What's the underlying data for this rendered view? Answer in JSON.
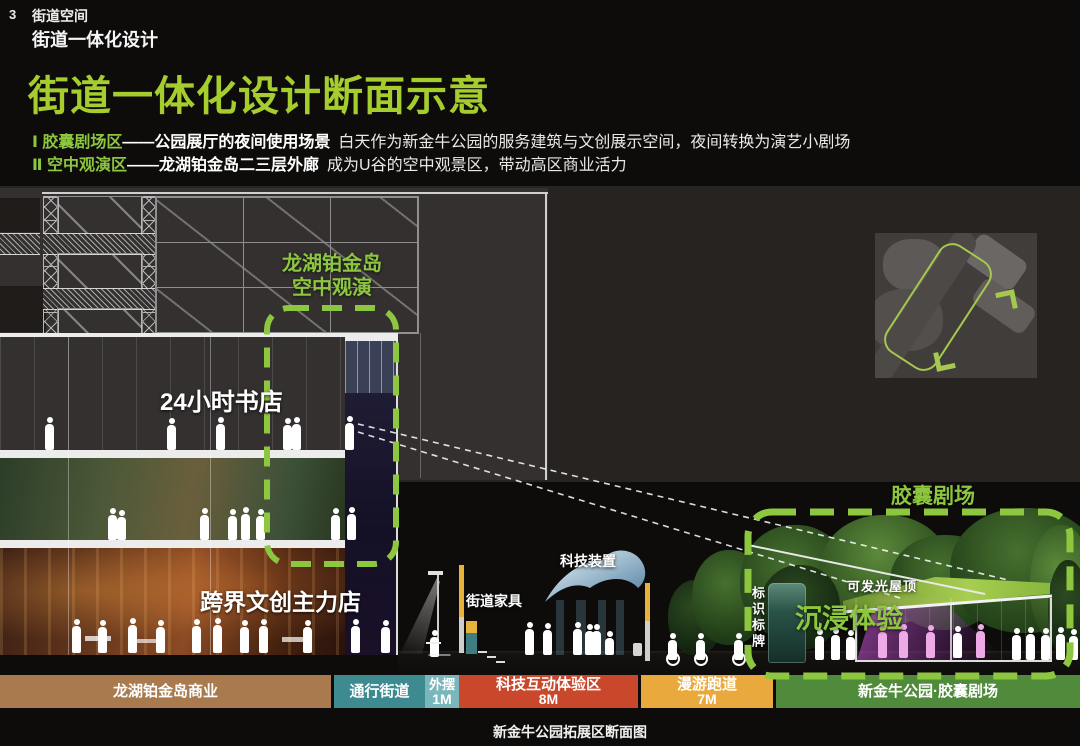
{
  "slide": {
    "page_number": "3",
    "section_label": "街道空间",
    "sub_label": "街道一体化设计",
    "title": "街道一体化设计断面示意",
    "bullets": [
      {
        "green": "Ⅰ 胶囊剧场区",
        "bold": "——公园展厅的夜间使用场景",
        "normal": "白天作为新金牛公园的服务建筑与文创展示空间，夜间转换为演艺小剧场"
      },
      {
        "green": "Ⅱ 空中观演区",
        "bold": "——龙湖铂金岛二三层外廊",
        "normal": "成为U谷的空中观景区，带动高区商业活力"
      }
    ]
  },
  "drawing": {
    "sky_label_line1": "龙湖铂金岛",
    "sky_label_line2": "空中观演",
    "bookstore": "24小时书店",
    "flagship": "跨界文创主力店",
    "street_furniture": "街道家具",
    "tech_installation": "科技装置",
    "signage": "标识标牌",
    "capsule_theater": "胶囊剧场",
    "luminous_roof": "可发光屋顶",
    "immersive": "沉浸体验"
  },
  "legend": {
    "segments": [
      {
        "label": "龙湖铂金岛商业",
        "size": "",
        "color": "#a97a4e"
      },
      {
        "label": "通行街道",
        "size": "",
        "color": "#3d8b90"
      },
      {
        "label": "外摆",
        "size": "1M",
        "color": "#7ab7bc"
      },
      {
        "label": "科技互动体验区",
        "size": "8M",
        "color": "#c9482c"
      },
      {
        "label": "漫游跑道",
        "size": "7M",
        "color": "#e9a93c"
      },
      {
        "label": "新金牛公园·胶囊剧场",
        "size": "",
        "color": "#4f8b3b"
      }
    ],
    "caption": "新金牛公园拓展区断面图"
  },
  "colors": {
    "title_green": "#a6cd2e",
    "label_green": "#8dc63f",
    "dash_green": "#8dc63f",
    "site_outline": "#a6c84f"
  }
}
